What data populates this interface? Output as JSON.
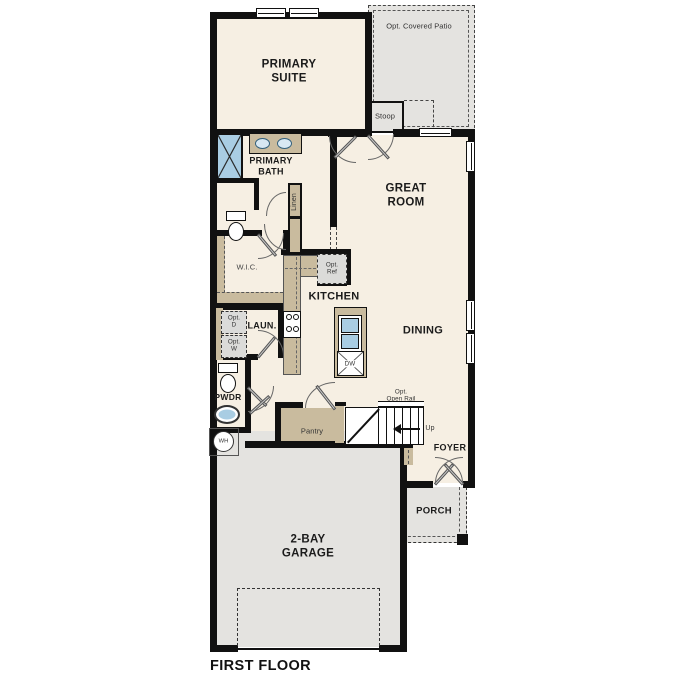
{
  "meta": {
    "floor_label": "FIRST FLOOR"
  },
  "rooms": {
    "primary_suite": "PRIMARY\nSUITE",
    "primary_bath": "PRIMARY\nBATH",
    "wic": "W.I.C.",
    "linen": "Linen",
    "great_room": "GREAT\nROOM",
    "kitchen": "KITCHEN",
    "dining": "DINING",
    "laundry": "LAUN.",
    "pwdr": "PWDR",
    "pantry": "Pantry",
    "foyer": "FOYER",
    "porch": "PORCH",
    "garage": "2-BAY\nGARAGE",
    "stoop": "Stoop",
    "patio": "Opt. Covered Patio"
  },
  "annotations": {
    "opt_ref": "Opt.\nRef",
    "opt_dryer": "Opt.\nD",
    "opt_washer": "Opt.\nW",
    "opt_open_rail": "Opt.\nOpen Rail",
    "up": "Up",
    "dishwasher": "DW",
    "water_heater": "WH"
  },
  "colors": {
    "interior_floor": "#f6efe3",
    "outdoor_floor": "#e4e3e0",
    "cabinet_tan": "#c9bb9e",
    "fixture_blue": "#a9cde3",
    "optional_gray": "#dbdbd9",
    "wall_black": "#111111"
  }
}
